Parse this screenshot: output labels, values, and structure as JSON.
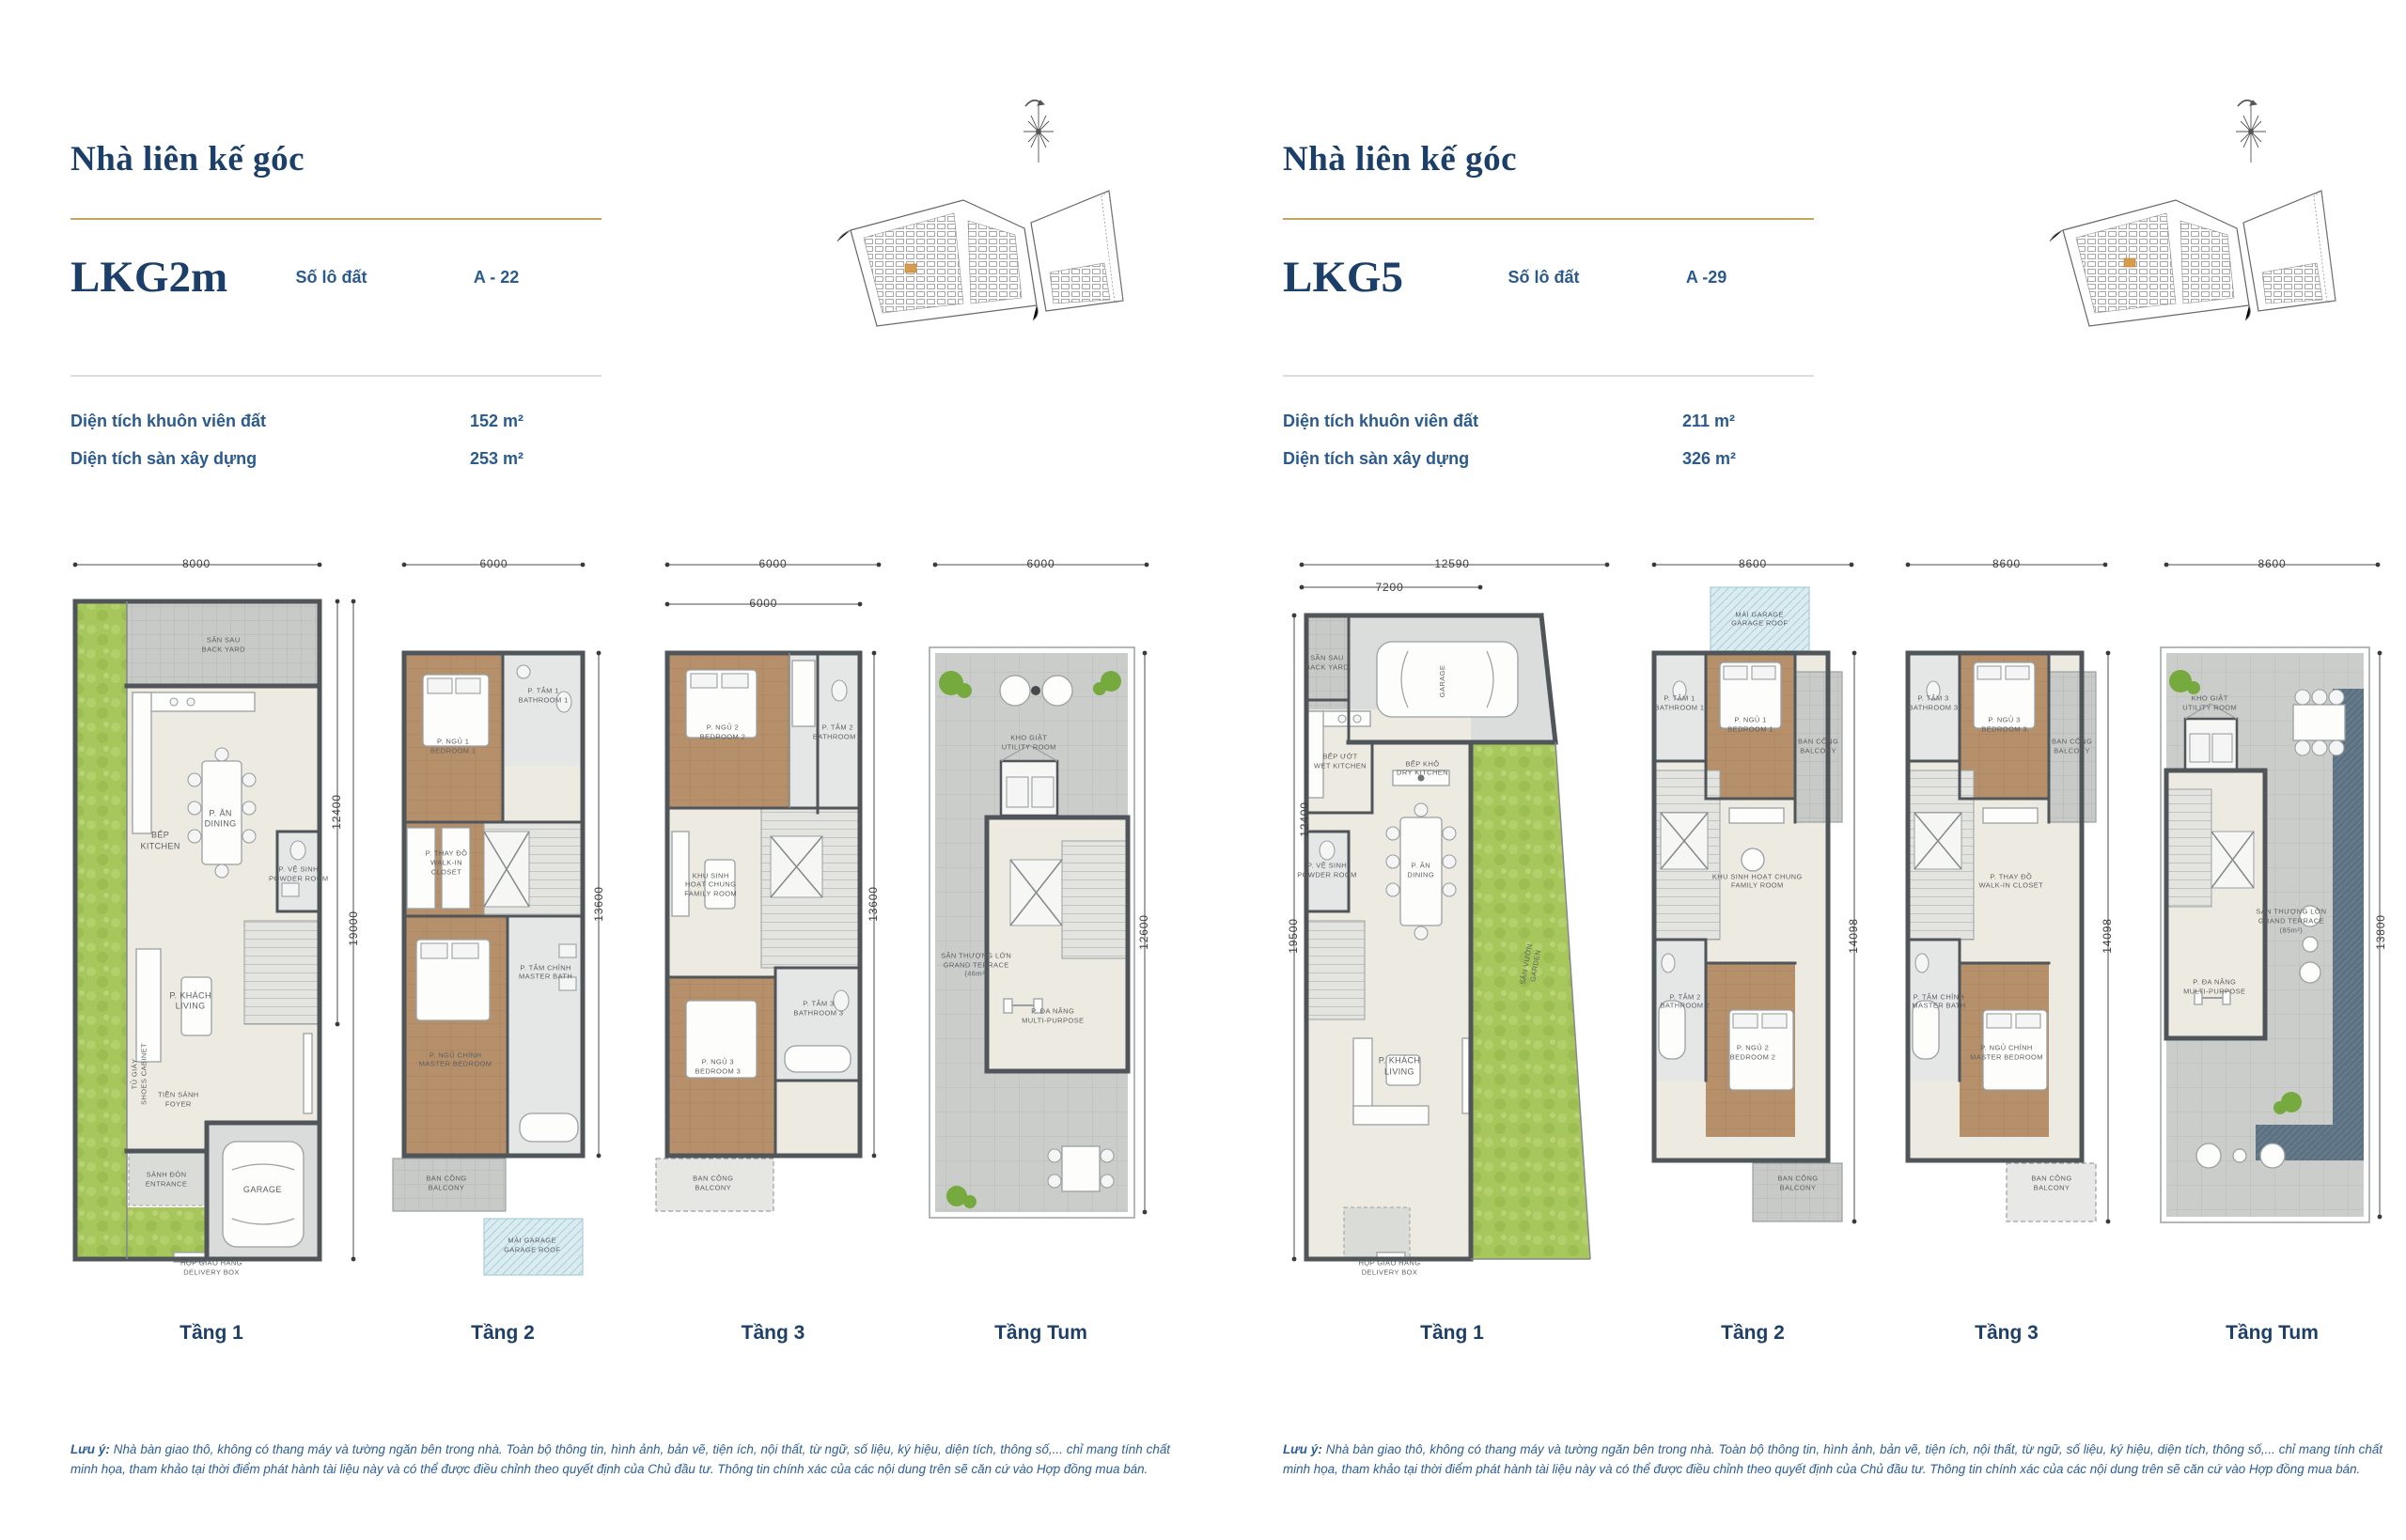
{
  "panels": [
    {
      "title": "Nhà liên kế góc",
      "model": "LKG2m",
      "lot_label": "Số lô đất",
      "lot_value": "A - 22",
      "specs": [
        {
          "label": "Diện tích khuôn viên đất",
          "value": "152 m²"
        },
        {
          "label": "Diện tích sàn xây dựng",
          "value": "253 m²"
        }
      ],
      "floors": [
        "Tầng 1",
        "Tầng 2",
        "Tầng 3",
        "Tầng Tum"
      ],
      "note_label": "Lưu ý:",
      "note": "Nhà bàn giao thô, không có thang máy và tường ngăn bên trong nhà. Toàn bộ thông tin, hình ảnh, bản vẽ, tiện ích, nội thất, từ ngữ, số liệu, ký hiệu, diện tích, thông số,... chỉ mang tính chất minh họa, tham khảo tại thời điểm phát hành tài liệu này và có thể được điều chỉnh theo quyết định của Chủ đầu tư. Thông tin chính xác của các nội dung trên sẽ căn cứ vào Hợp đồng mua bán."
    },
    {
      "title": "Nhà liên kế góc",
      "model": "LKG5",
      "lot_label": "Số lô đất",
      "lot_value": "A -29",
      "specs": [
        {
          "label": "Diện tích khuôn viên đất",
          "value": "211 m²"
        },
        {
          "label": "Diện tích sàn xây dựng",
          "value": "326 m²"
        }
      ],
      "floors": [
        "Tầng 1",
        "Tầng 2",
        "Tầng 3",
        "Tầng Tum"
      ],
      "note_label": "Lưu ý:",
      "note": "Nhà bàn giao thô, không có thang máy và tường ngăn bên trong nhà. Toàn bộ thông tin, hình ảnh, bản vẽ, tiện ích, nội thất, từ ngữ, số liệu, ký hiệu, diện tích, thông số,... chỉ mang tính chất minh họa, tham khảo tại thời điểm phát hành tài liệu này và có thể được điều chỉnh theo quyết định của Chủ đầu tư. Thông tin chính xác của các nội dung trên sẽ căn cứ vào Hợp đồng mua bán."
    }
  ],
  "colors": {
    "navy": "#1c3f69",
    "blue": "#2b5a8c",
    "gold": "#c8a463",
    "lot_highlight": "#d79b4e"
  },
  "plans": {
    "l1": {
      "labels": [
        {
          "t": [
            "8000"
          ],
          "x": 45,
          "y": 2,
          "cls": "dim"
        },
        {
          "t": [
            "12400"
          ],
          "x": 92,
          "y": 36,
          "cls": "dim",
          "rot": -90
        },
        {
          "t": [
            "19000"
          ],
          "x": 97.5,
          "y": 52,
          "cls": "dim",
          "rot": -90
        },
        {
          "t": [
            "SÂN SAU",
            "BACK YARD"
          ],
          "x": 54,
          "y": 13,
          "cls": "sm"
        },
        {
          "t": [
            "BẾP",
            "KITCHEN"
          ],
          "x": 33,
          "y": 40,
          "cls": "room"
        },
        {
          "t": [
            "P. ĂN",
            "DINING"
          ],
          "x": 53,
          "y": 37,
          "cls": "room"
        },
        {
          "t": [
            "P. VỆ SINH",
            "POWDER ROOM"
          ],
          "x": 79,
          "y": 44.5,
          "cls": "sm"
        },
        {
          "t": [
            "P. KHÁCH",
            "LIVING"
          ],
          "x": 43,
          "y": 62,
          "cls": "room"
        },
        {
          "t": [
            "TỦ GIÀY",
            "SHOES CABINET"
          ],
          "x": 26,
          "y": 72,
          "cls": "sm",
          "rot": -90
        },
        {
          "t": [
            "TIỀN SẢNH",
            "FOYER"
          ],
          "x": 39,
          "y": 75.5,
          "cls": "sm"
        },
        {
          "t": [
            "SẢNH ĐÓN",
            "ENTRANCE"
          ],
          "x": 35,
          "y": 86.5,
          "cls": "sm"
        },
        {
          "t": [
            "GARAGE"
          ],
          "x": 67,
          "y": 88,
          "cls": "room"
        },
        {
          "t": [
            "HỘP GIAO HÀNG",
            "DELIVERY BOX"
          ],
          "x": 50,
          "y": 98.6,
          "cls": "sm"
        }
      ]
    },
    "l2": {
      "labels": [
        {
          "t": [
            "6000"
          ],
          "x": 46,
          "y": 2,
          "cls": "dim"
        },
        {
          "t": [
            "13600"
          ],
          "x": 93,
          "y": 48.6,
          "cls": "dim",
          "rot": -90
        },
        {
          "t": [
            "P. NGỦ 1",
            "BEDROOM 1"
          ],
          "x": 28,
          "y": 27,
          "cls": "sm"
        },
        {
          "t": [
            "P. TẮM 1",
            "BATHROOM 1"
          ],
          "x": 68,
          "y": 20,
          "cls": "sm"
        },
        {
          "t": [
            "P. THAY ĐỒ",
            "WALK-IN",
            "CLOSET"
          ],
          "x": 25,
          "y": 43,
          "cls": "sm"
        },
        {
          "t": [
            "P. TẮM CHÍNH",
            "MASTER BATH"
          ],
          "x": 69,
          "y": 58,
          "cls": "sm"
        },
        {
          "t": [
            "P. NGỦ CHÍNH",
            "MASTER BEDROOM"
          ],
          "x": 29,
          "y": 70,
          "cls": "sm"
        },
        {
          "t": [
            "BAN CÔNG",
            "BALCONY"
          ],
          "x": 25,
          "y": 87,
          "cls": "sm"
        },
        {
          "t": [
            "MÁI GARAGE",
            "GARAGE ROOF"
          ],
          "x": 63,
          "y": 95.5,
          "cls": "sm"
        }
      ]
    },
    "l3": {
      "labels": [
        {
          "t": [
            "6000"
          ],
          "x": 50,
          "y": 2,
          "cls": "dim"
        },
        {
          "t": [
            "6000"
          ],
          "x": 46,
          "y": 7.5,
          "cls": "dim"
        },
        {
          "t": [
            "13600"
          ],
          "x": 92,
          "y": 48.6,
          "cls": "dim",
          "rot": -90
        },
        {
          "t": [
            "P. NGỦ 2",
            "BEDROOM 2"
          ],
          "x": 29,
          "y": 25,
          "cls": "sm"
        },
        {
          "t": [
            "P. TẮM 2",
            "BATHROOM 2"
          ],
          "x": 77,
          "y": 25,
          "cls": "sm"
        },
        {
          "t": [
            "KHU SINH",
            "HOẠT CHUNG",
            "FAMILY ROOM"
          ],
          "x": 24,
          "y": 46,
          "cls": "sm"
        },
        {
          "t": [
            "P. NGỦ 3",
            "BEDROOM 3"
          ],
          "x": 27,
          "y": 71,
          "cls": "sm"
        },
        {
          "t": [
            "P. TẮM 3",
            "BATHROOM 3"
          ],
          "x": 69,
          "y": 63,
          "cls": "sm"
        },
        {
          "t": [
            "BAN CÔNG",
            "BALCONY"
          ],
          "x": 25,
          "y": 87,
          "cls": "sm"
        }
      ]
    },
    "l4": {
      "labels": [
        {
          "t": [
            "6000"
          ],
          "x": 50,
          "y": 2,
          "cls": "dim"
        },
        {
          "t": [
            "12600"
          ],
          "x": 93.5,
          "y": 52.5,
          "cls": "dim",
          "rot": -90
        },
        {
          "t": [
            "KHO GIẶT",
            "UTILITY ROOM"
          ],
          "x": 45,
          "y": 26.5,
          "cls": "sm"
        },
        {
          "t": [
            "SÂN THƯỢNG LỚN",
            "GRAND TERRACE",
            "(46m²)"
          ],
          "x": 23,
          "y": 57,
          "cls": "sm"
        },
        {
          "t": [
            "P. ĐA NĂNG",
            "MULTI-PURPOSE"
          ],
          "x": 55,
          "y": 64,
          "cls": "sm"
        }
      ]
    },
    "r1": {
      "labels": [
        {
          "t": [
            "12590"
          ],
          "x": 50,
          "y": 2,
          "cls": "dim"
        },
        {
          "t": [
            "7200"
          ],
          "x": 31,
          "y": 5.3,
          "cls": "dim"
        },
        {
          "t": [
            "12400"
          ],
          "x": 5.5,
          "y": 37,
          "cls": "dim",
          "rot": -90
        },
        {
          "t": [
            "19500"
          ],
          "x": 2,
          "y": 53,
          "cls": "dim",
          "rot": -90
        },
        {
          "t": [
            "SÂN SAU",
            "BACK YARD"
          ],
          "x": 12,
          "y": 15.5,
          "cls": "sm"
        },
        {
          "t": [
            "GARAGE"
          ],
          "x": 47,
          "y": 18,
          "cls": "sm",
          "rot": -90
        },
        {
          "t": [
            "BẾP ƯỚT",
            "WET KITCHEN"
          ],
          "x": 16,
          "y": 29,
          "cls": "sm"
        },
        {
          "t": [
            "P. VỆ SINH",
            "POWDER ROOM"
          ],
          "x": 12,
          "y": 44,
          "cls": "sm"
        },
        {
          "t": [
            "BẾP KHÔ",
            "DRY KITCHEN"
          ],
          "x": 41,
          "y": 30,
          "cls": "sm"
        },
        {
          "t": [
            "P. ĂN",
            "DINING"
          ],
          "x": 40.5,
          "y": 44,
          "cls": "sm"
        },
        {
          "t": [
            "P. KHÁCH",
            "LIVING"
          ],
          "x": 34,
          "y": 71,
          "cls": "room"
        },
        {
          "t": [
            "SÂN VƯỜN",
            "GARDEN"
          ],
          "x": 74,
          "y": 57,
          "cls": "sm",
          "rot": -80
        },
        {
          "t": [
            "HỘP GIAO HÀNG",
            "DELIVERY BOX"
          ],
          "x": 31,
          "y": 98.6,
          "cls": "sm"
        }
      ]
    },
    "r2": {
      "labels": [
        {
          "t": [
            "8600"
          ],
          "x": 50,
          "y": 2,
          "cls": "dim"
        },
        {
          "t": [
            "14098"
          ],
          "x": 95,
          "y": 53,
          "cls": "dim",
          "rot": -90
        },
        {
          "t": [
            "MÁI GARAGE",
            "GARAGE ROOF"
          ],
          "x": 53,
          "y": 9.5,
          "cls": "sm"
        },
        {
          "t": [
            "P. TẮM 1",
            "BATHROOM 1"
          ],
          "x": 17.5,
          "y": 21,
          "cls": "sm"
        },
        {
          "t": [
            "P. NGỦ 1",
            "BEDROOM 1"
          ],
          "x": 49,
          "y": 24,
          "cls": "sm"
        },
        {
          "t": [
            "BAN CÔNG",
            "BALCONY"
          ],
          "x": 79,
          "y": 27,
          "cls": "sm"
        },
        {
          "t": [
            "KHU SINH HOẠT CHUNG",
            "FAMILY ROOM"
          ],
          "x": 52,
          "y": 45.5,
          "cls": "sm"
        },
        {
          "t": [
            "P. TẮM 2",
            "BATHROOM 2"
          ],
          "x": 20,
          "y": 62,
          "cls": "sm"
        },
        {
          "t": [
            "P. NGỦ 2",
            "BEDROOM 2"
          ],
          "x": 50,
          "y": 69,
          "cls": "sm"
        },
        {
          "t": [
            "BAN CÔNG",
            "BALCONY"
          ],
          "x": 70,
          "y": 87,
          "cls": "sm"
        }
      ]
    },
    "r3": {
      "labels": [
        {
          "t": [
            "8600"
          ],
          "x": 50,
          "y": 2,
          "cls": "dim"
        },
        {
          "t": [
            "14098"
          ],
          "x": 95,
          "y": 53,
          "cls": "dim",
          "rot": -90
        },
        {
          "t": [
            "P. TẮM 3",
            "BATHROOM 3"
          ],
          "x": 17.5,
          "y": 21,
          "cls": "sm"
        },
        {
          "t": [
            "P. NGỦ 3",
            "BEDROOM 3"
          ],
          "x": 49,
          "y": 24,
          "cls": "sm"
        },
        {
          "t": [
            "BAN CÔNG",
            "BALCONY"
          ],
          "x": 79,
          "y": 27,
          "cls": "sm"
        },
        {
          "t": [
            "P. THAY ĐỒ",
            "WALK-IN CLOSET"
          ],
          "x": 52,
          "y": 45.5,
          "cls": "sm"
        },
        {
          "t": [
            "P. TẮM CHÍNH",
            "MASTER BATH"
          ],
          "x": 20,
          "y": 62,
          "cls": "sm"
        },
        {
          "t": [
            "P. NGỦ CHÍNH",
            "MASTER BEDROOM"
          ],
          "x": 50,
          "y": 69,
          "cls": "sm"
        },
        {
          "t": [
            "BAN CÔNG",
            "BALCONY"
          ],
          "x": 70,
          "y": 87,
          "cls": "sm"
        }
      ]
    },
    "r4": {
      "labels": [
        {
          "t": [
            "8600"
          ],
          "x": 50,
          "y": 2,
          "cls": "dim"
        },
        {
          "t": [
            "13800"
          ],
          "x": 95.5,
          "y": 52.5,
          "cls": "dim",
          "rot": -90
        },
        {
          "t": [
            "KHO GIẶT",
            "UTILITY ROOM"
          ],
          "x": 24,
          "y": 21,
          "cls": "sm"
        },
        {
          "t": [
            "SÂN THƯỢNG LỚN",
            "GRAND TERRACE",
            "(85m²)"
          ],
          "x": 58,
          "y": 51,
          "cls": "sm"
        },
        {
          "t": [
            "P. ĐA NĂNG",
            "MULTI-PURPOSE"
          ],
          "x": 26,
          "y": 60,
          "cls": "sm"
        }
      ]
    }
  }
}
